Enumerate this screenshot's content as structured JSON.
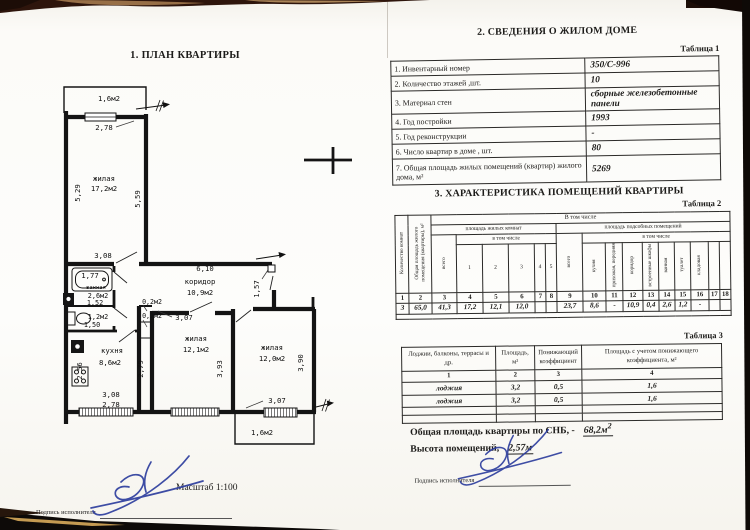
{
  "left": {
    "title": "1. ПЛАН КВАРТИРЫ",
    "scale": "Масштаб 1:100",
    "signature_label": "Подпись исполнителя"
  },
  "right": {
    "section2_title": "2. СВЕДЕНИЯ О ЖИЛОМ ДОМЕ",
    "section3_title": "3. ХАРАКТЕРИСТИКА ПОМЕЩЕНИЙ КВАРТИРЫ",
    "signature_label": "Подпись исполнителя",
    "total_area_label": "Общая площадь квартиры по СНБ, -",
    "total_area_value": "68,2м",
    "total_area_sup": "2",
    "height_label": "Высота помещений,",
    "height_value": "2,57м"
  },
  "table1": {
    "caption": "Таблица 1",
    "rows": [
      {
        "label": "1. Инвентарный номер",
        "value": "350/С-996"
      },
      {
        "label": "2. Количество этажей ,шт.",
        "value": "10"
      },
      {
        "label": "3. Материал стен",
        "value": "сборные железобетонные панели"
      },
      {
        "label": "4. Год постройки",
        "value": "1993"
      },
      {
        "label": "5. Год реконструкции",
        "value": "-"
      },
      {
        "label": "6. Число квартир в доме , шт.",
        "value": "80"
      },
      {
        "label": "7. Общая площадь жилых помещений (квартир) жилого дома, м²",
        "value": "5269"
      }
    ]
  },
  "table2": {
    "caption": "Таблица 2",
    "col1": "Количество комнат",
    "col2": "Общая площадь жилого помещения (квартиры), м²",
    "group_total": "В том числе",
    "living": "площадь жилых комнат",
    "aux": "площадь подсобных помещений",
    "vsego1": "всего",
    "vtom1": "в том числе",
    "vsego2": "всего",
    "vtom2": "в том числе",
    "living_nums": [
      "1",
      "2",
      "3",
      "4",
      "5"
    ],
    "aux_labels": [
      "кухня",
      "прихожая, передняя",
      "коридор",
      "встроенные шкафы",
      "ванная",
      "туалет",
      "кладовая",
      "",
      ""
    ],
    "col_numbers": [
      "1",
      "2",
      "3",
      "4",
      "5",
      "6",
      "7",
      "8",
      "9",
      "10",
      "11",
      "12",
      "13",
      "14",
      "15",
      "16",
      "17",
      "18"
    ],
    "data_row": [
      "3",
      "65,0",
      "41,3",
      "17,2",
      "12,1",
      "12,0",
      "",
      "",
      "23,7",
      "8,6",
      "-",
      "10,9",
      "0,4",
      "2,6",
      "1,2",
      "-",
      "",
      ""
    ]
  },
  "table3": {
    "caption": "Таблица 3",
    "headers": [
      "Лоджии, балконы, террасы и др.",
      "Площадь, м²",
      "Понижающий коэффициент",
      "Площадь с учетом понижающего коэффициента, м²"
    ],
    "col_numbers": [
      "1",
      "2",
      "3",
      "4"
    ],
    "rows": [
      [
        "лоджия",
        "3,2",
        "0,5",
        "1,6"
      ],
      [
        "лоджия",
        "3,2",
        "0,5",
        "1,6"
      ],
      [
        "",
        "",
        "",
        ""
      ],
      [
        "",
        "",
        "",
        ""
      ]
    ]
  },
  "plan": {
    "labels": [
      {
        "x": 109,
        "y": 101,
        "t": "1,6м2"
      },
      {
        "x": 104,
        "y": 130,
        "t": "2,78"
      },
      {
        "x": 104,
        "y": 181,
        "t": "жилая"
      },
      {
        "x": 104,
        "y": 191,
        "t": "17,2м2"
      },
      {
        "x": 80,
        "y": 193,
        "t": "5,29",
        "r": -90
      },
      {
        "x": 140,
        "y": 199,
        "t": "5,59",
        "r": -90
      },
      {
        "x": 103,
        "y": 258,
        "t": "3,08"
      },
      {
        "x": 90,
        "y": 278,
        "t": "1,77"
      },
      {
        "x": 96,
        "y": 289,
        "t": "ванная",
        "s": 5.5
      },
      {
        "x": 98,
        "y": 298,
        "t": "2,6м2",
        "s": 6.8
      },
      {
        "x": 95,
        "y": 305,
        "t": "1,52",
        "s": 6.8
      },
      {
        "x": 98,
        "y": 319,
        "t": "1,2м2",
        "s": 6.8
      },
      {
        "x": 92,
        "y": 327,
        "t": "1,50",
        "s": 6.8
      },
      {
        "x": 205,
        "y": 271,
        "t": "6,10"
      },
      {
        "x": 200,
        "y": 284,
        "t": "коридор"
      },
      {
        "x": 200,
        "y": 295,
        "t": "10,9м2"
      },
      {
        "x": 259,
        "y": 289,
        "t": "1,57",
        "r": -90
      },
      {
        "x": 152,
        "y": 304,
        "t": "0,2м2",
        "s": 6.6
      },
      {
        "x": 152,
        "y": 318,
        "t": "0,2м2",
        "s": 6.6
      },
      {
        "x": 184,
        "y": 320,
        "t": "3,07"
      },
      {
        "x": 196,
        "y": 341,
        "t": "жилая"
      },
      {
        "x": 196,
        "y": 352,
        "t": "12,1м2"
      },
      {
        "x": 143,
        "y": 369,
        "t": "2,79",
        "r": -90
      },
      {
        "x": 222,
        "y": 369,
        "t": "3,93",
        "r": -90
      },
      {
        "x": 272,
        "y": 350,
        "t": "жилая"
      },
      {
        "x": 272,
        "y": 361,
        "t": "12,0м2"
      },
      {
        "x": 303,
        "y": 363,
        "t": "3,90",
        "r": -90
      },
      {
        "x": 277,
        "y": 403,
        "t": "3,07"
      },
      {
        "x": 262,
        "y": 435,
        "t": "1,6м2"
      },
      {
        "x": 112,
        "y": 353,
        "t": "кухня"
      },
      {
        "x": 110,
        "y": 365,
        "t": "8,6м2"
      },
      {
        "x": 82,
        "y": 371,
        "t": "2,56",
        "r": -90
      },
      {
        "x": 111,
        "y": 397,
        "t": "3,08"
      },
      {
        "x": 111,
        "y": 407,
        "t": "2,78"
      }
    ]
  }
}
